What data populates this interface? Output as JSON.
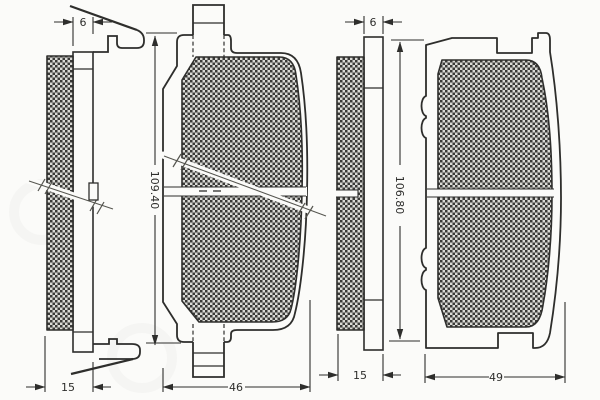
{
  "drawing": {
    "type": "brake-pad-technical-drawing",
    "views": [
      {
        "id": "left-pad-side-view",
        "plate_thickness": "6",
        "total_thickness": "15"
      },
      {
        "id": "left-pad-front-view",
        "height": "109.40",
        "width": "46"
      },
      {
        "id": "right-pad-side-view",
        "plate_thickness": "6",
        "total_thickness": "15"
      },
      {
        "id": "right-pad-front-view",
        "height": "106.80",
        "width": "49"
      }
    ],
    "colors": {
      "background": "#fbfbf9",
      "line": "#2e2e2c",
      "friction_dark": "#3a3a38",
      "friction_light": "#dadad6",
      "break_line": "#55554f"
    }
  }
}
